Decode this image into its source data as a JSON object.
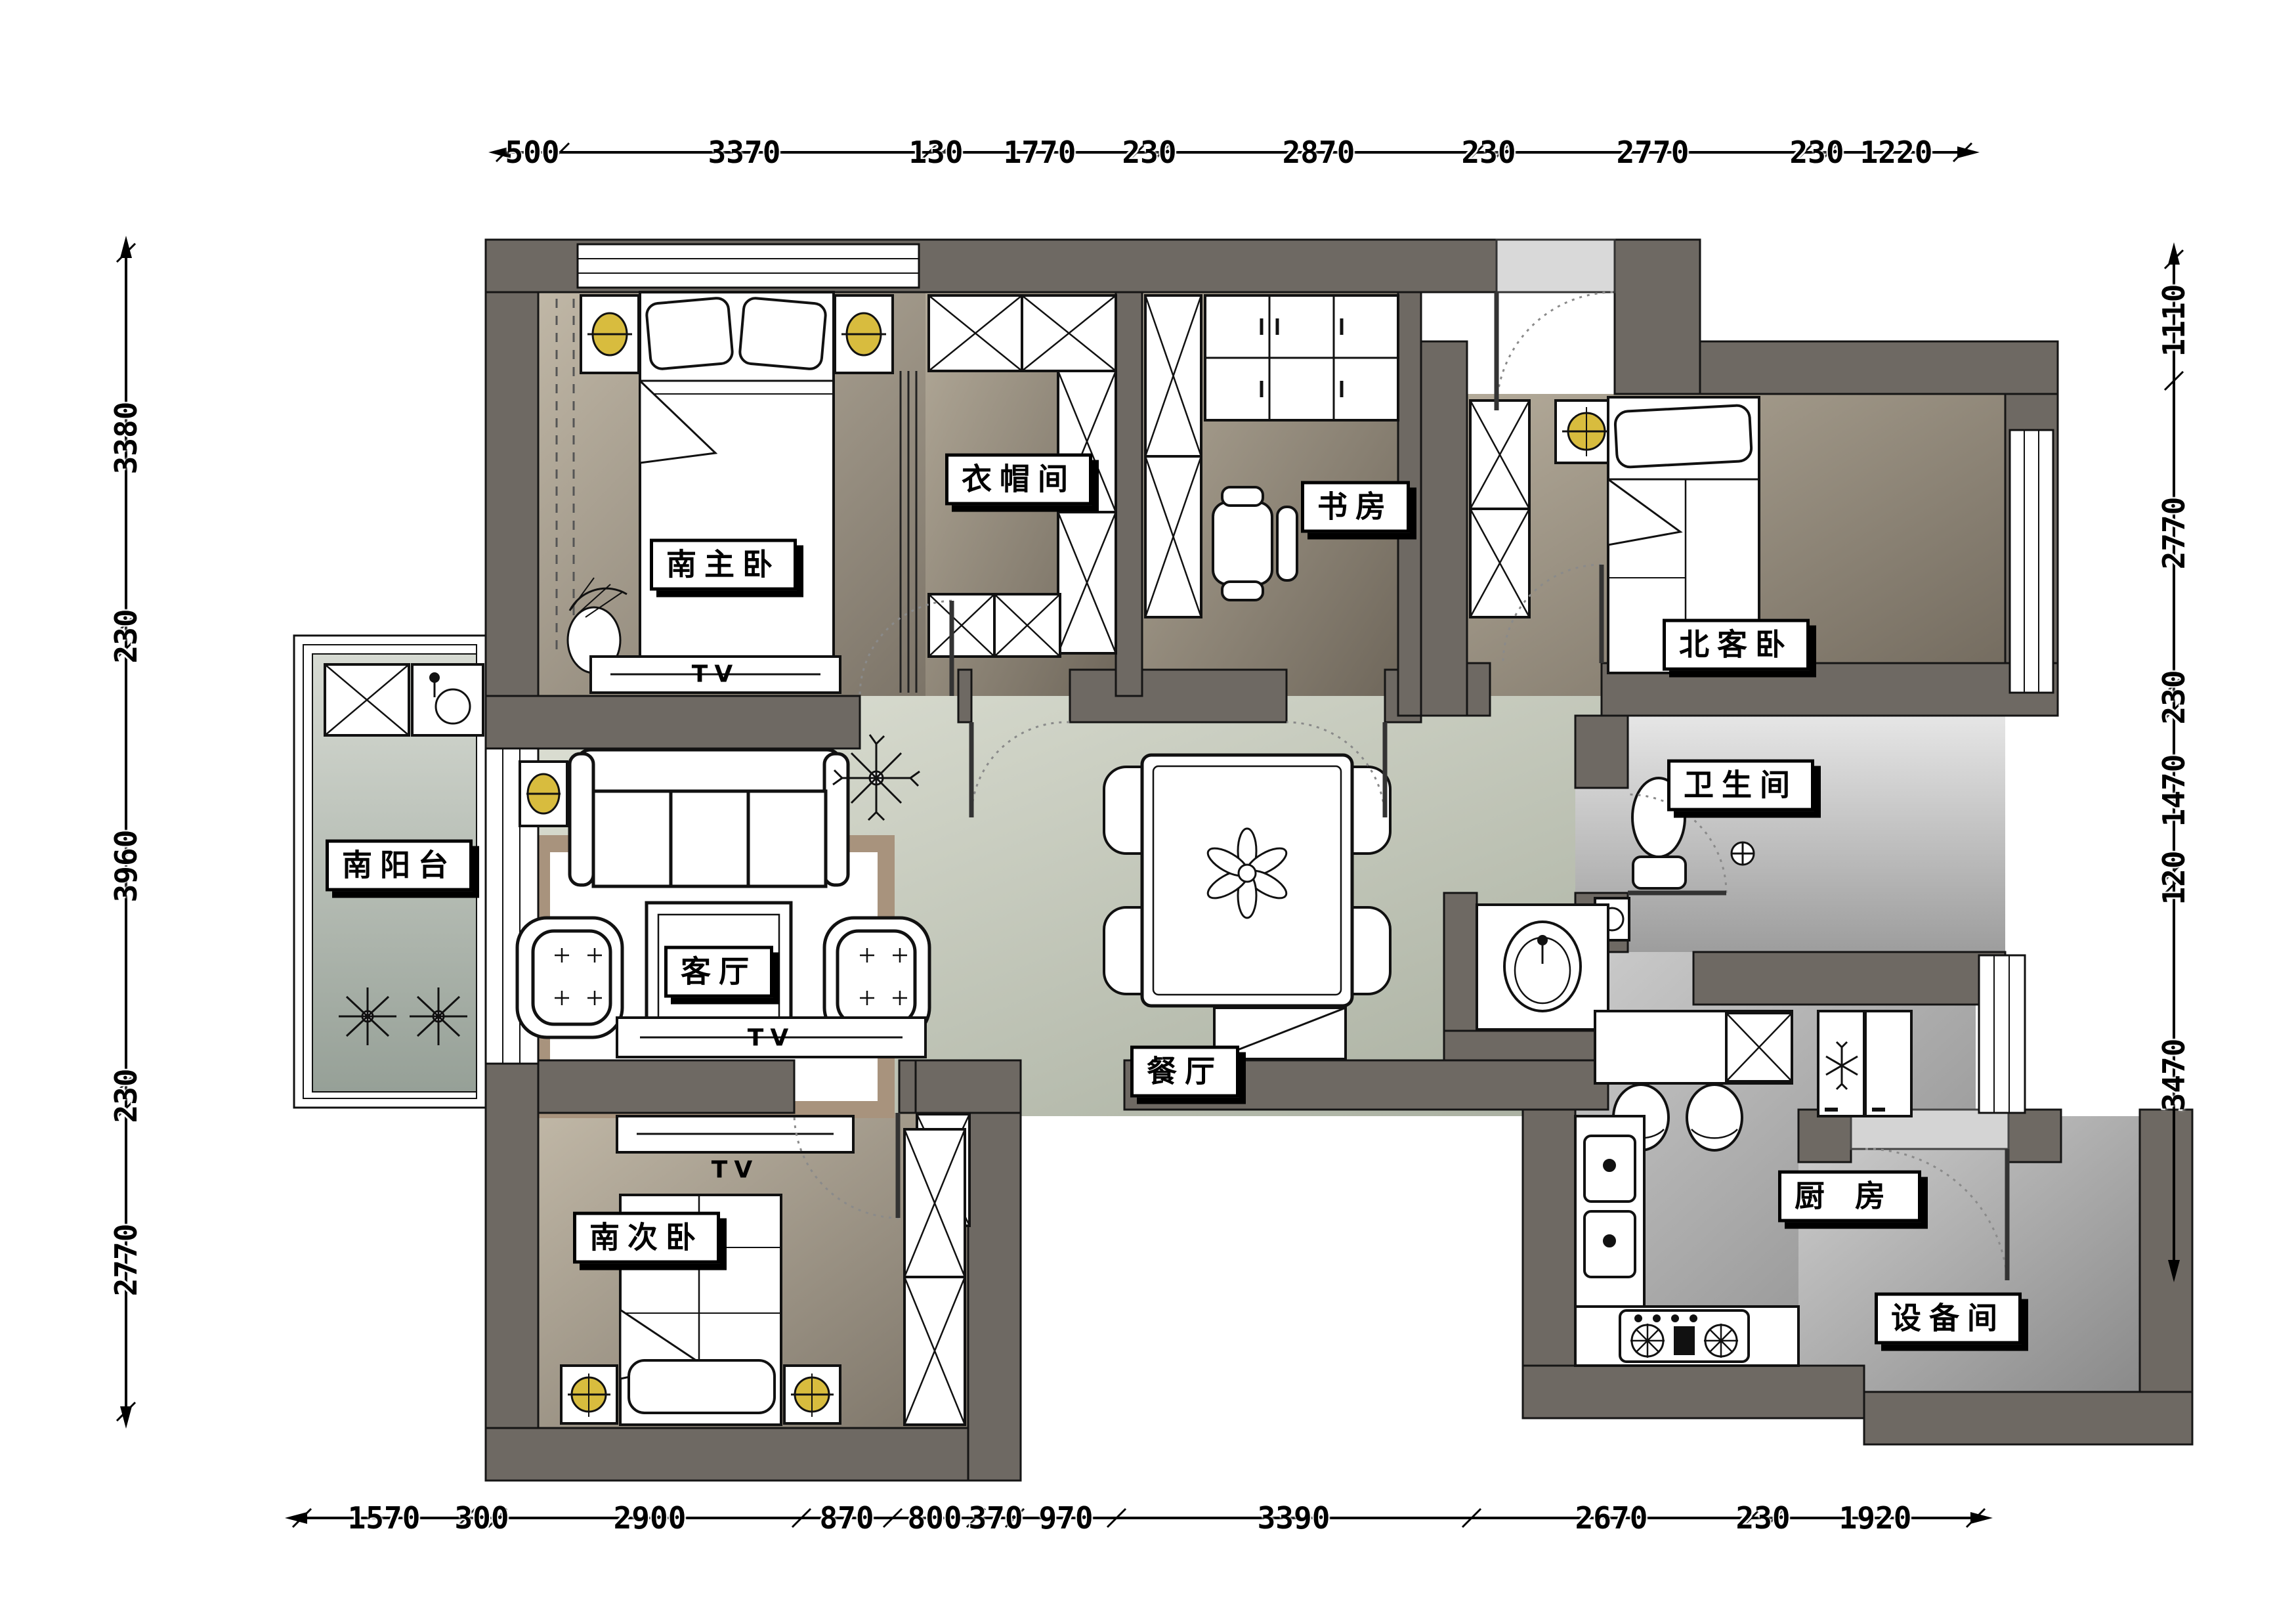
{
  "plan_title": "apartment-floor-plan",
  "rooms": {
    "master_bedroom": {
      "label": "南主卧"
    },
    "cloakroom": {
      "label": "衣帽间"
    },
    "study": {
      "label": "书房"
    },
    "north_guest_bedroom": {
      "label": "北客卧"
    },
    "south_balcony": {
      "label": "南阳台"
    },
    "living_room": {
      "label": "客厅"
    },
    "dining_room": {
      "label": "餐厅"
    },
    "bathroom": {
      "label": "卫生间"
    },
    "kitchen": {
      "label": "厨房"
    },
    "equipment_room": {
      "label": "设备间"
    },
    "south_second_bedroom": {
      "label": "南次卧"
    }
  },
  "annotations": {
    "tv": "TV"
  },
  "dimensions_mm": {
    "top": [
      "500",
      "3370",
      "130",
      "1770",
      "230",
      "2870",
      "230",
      "2770",
      "230",
      "1220"
    ],
    "bottom": [
      "1570",
      "300",
      "2900",
      "870",
      "800",
      "370",
      "970",
      "3390",
      "2670",
      "230",
      "1920"
    ],
    "left": [
      "3380",
      "230",
      "3960",
      "230",
      "2770"
    ],
    "right": [
      "1110",
      "2770",
      "230",
      "1470",
      "120",
      "3470"
    ]
  },
  "colors": {
    "wall": "#6e6963",
    "floor_bedroom": "#b8afa0",
    "floor_hall": "#d9dcd0",
    "floor_kitchen": "#b5b5b5",
    "rug_border": "#a8937d",
    "lamp_accent": "#d8bc3e"
  }
}
